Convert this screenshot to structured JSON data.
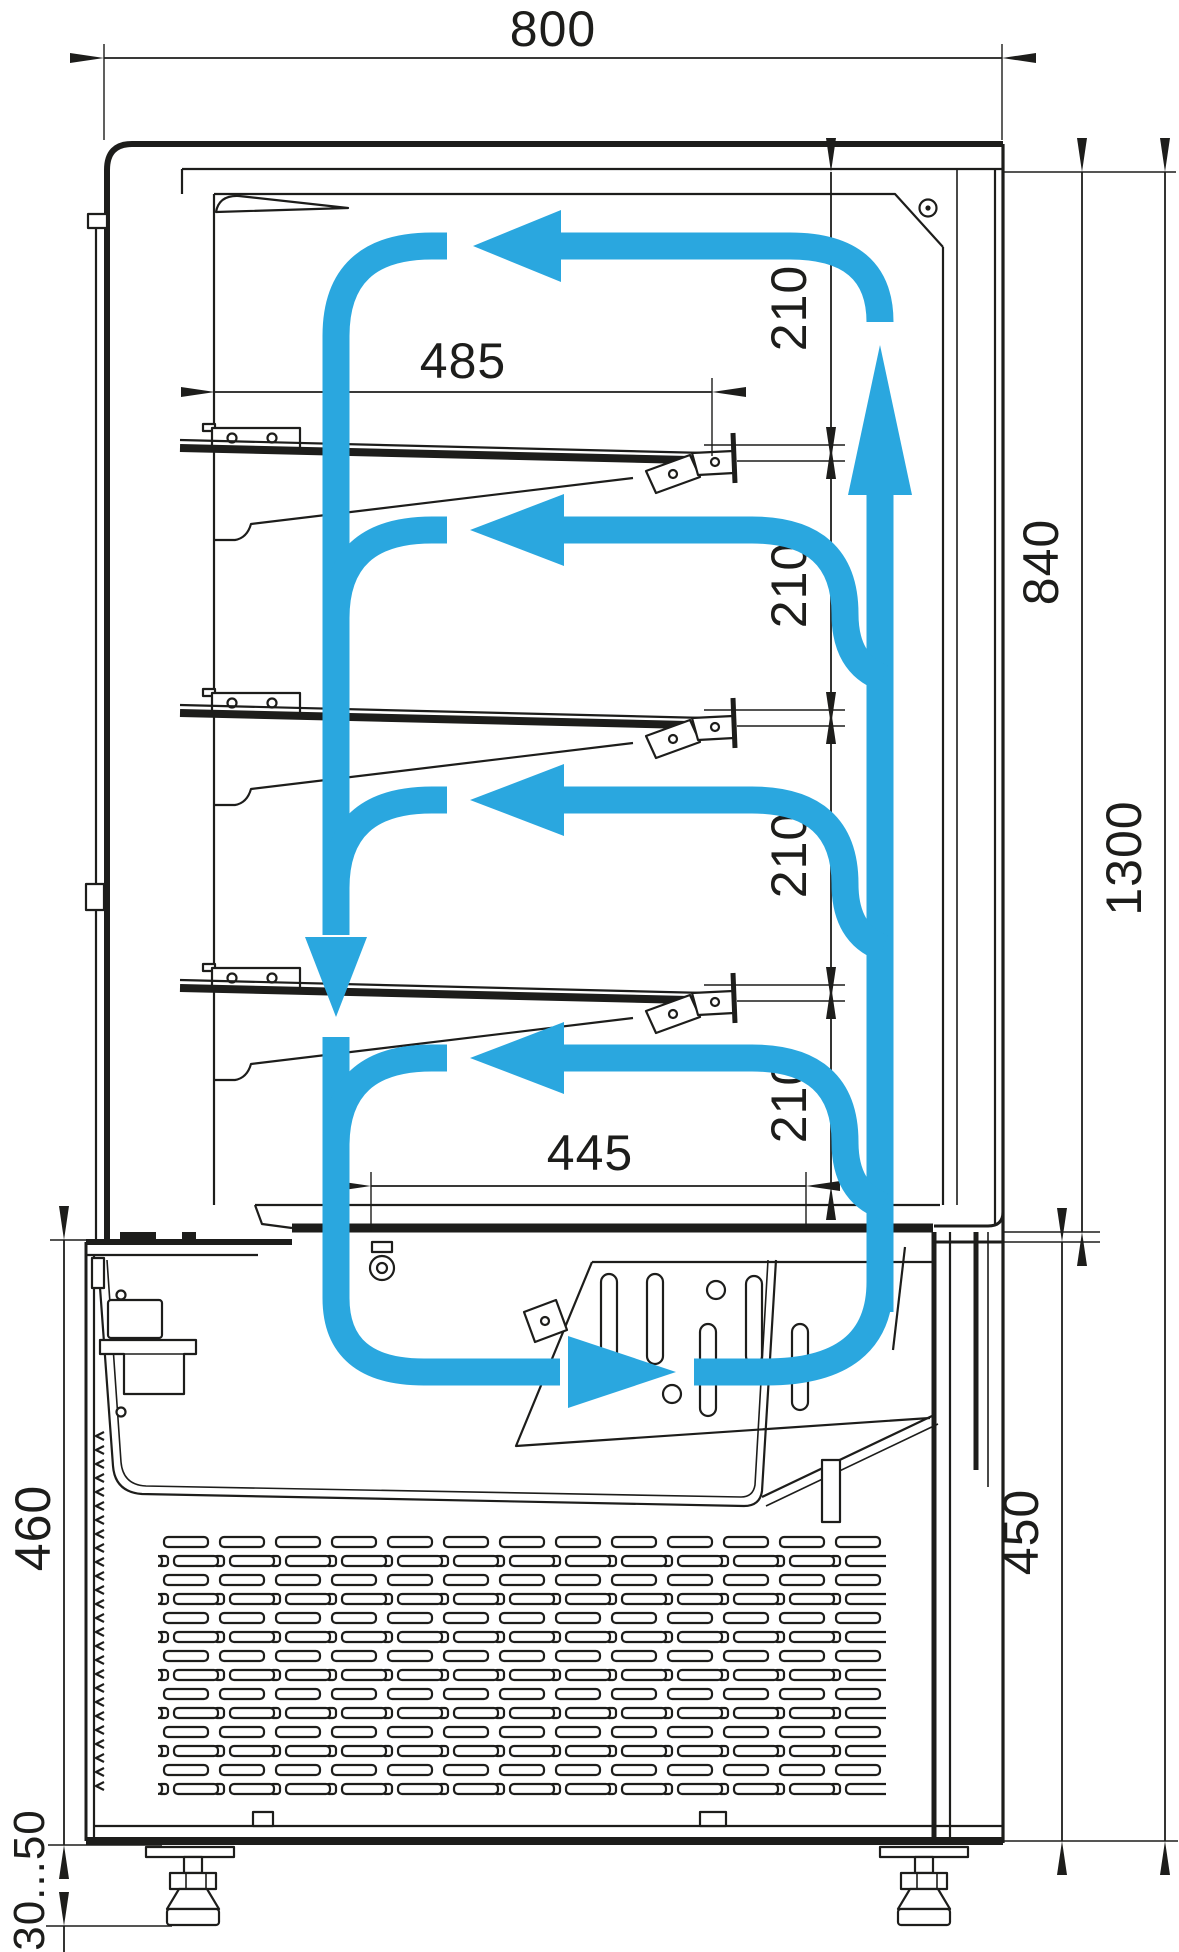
{
  "diagram": {
    "subject": "Refrigerated display case — vertical cross-section with air circulation arrows",
    "units": "mm",
    "colors": {
      "line": "#1d1d1b",
      "airflow": "#2aa7df",
      "background": "#ffffff"
    },
    "labels": {
      "overall_width": "800",
      "shelf_length": "485",
      "gap_top": "210",
      "gap_1": "210",
      "gap_2": "210",
      "gap_3": "210",
      "bottom_shelf_length": "445",
      "display_chamber_height": "840",
      "overall_body_height": "1300",
      "base_height_right": "450",
      "base_height_left": "460",
      "foot_adjustment": "30...50"
    }
  }
}
